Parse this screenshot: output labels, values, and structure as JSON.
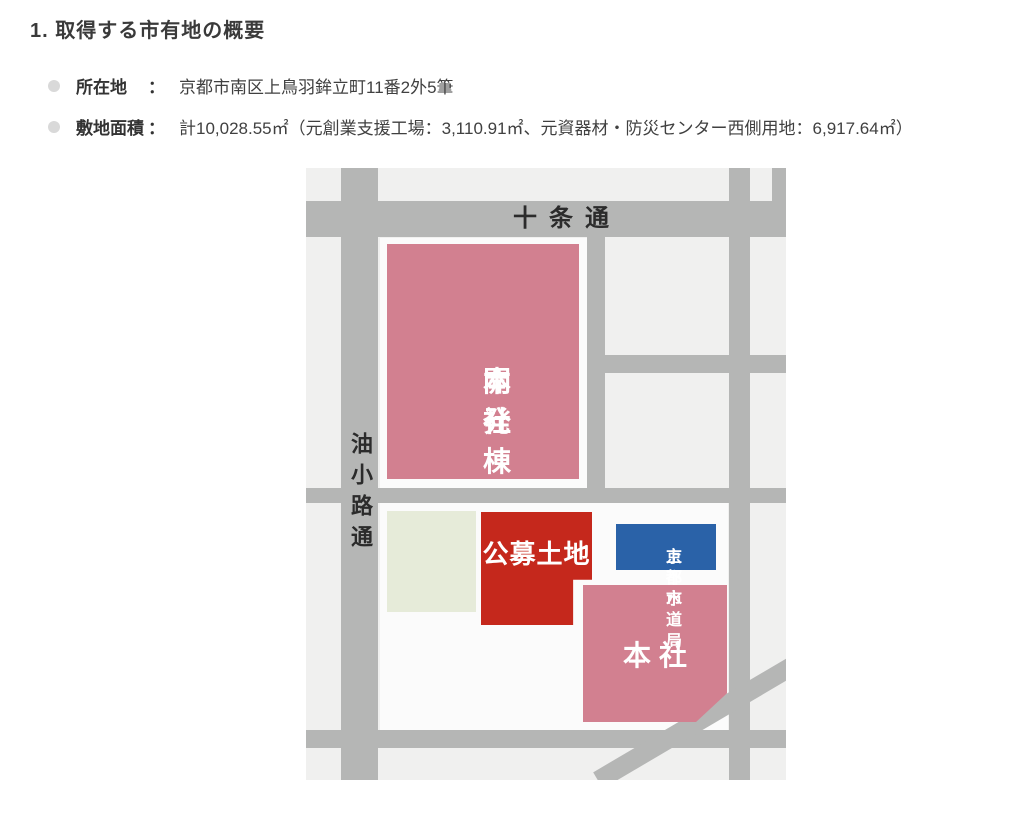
{
  "page": {
    "title": "1. 取得する市有地の概要",
    "bullets": [
      {
        "label": "所在地",
        "separator": "：",
        "value": "京都市南区上鳥羽鉾立町11番2外5筆"
      },
      {
        "label": "敷地面積",
        "separator": "：",
        "value": "計10,028.55㎡（元創業支援工場：3,110.91㎡、元資器材・防災センター西側用地：6,917.64㎡）"
      }
    ]
  },
  "map": {
    "streets": {
      "jujo": "十条通",
      "aburanokoji": "油小路通"
    },
    "buildings": {
      "head_office_dev": {
        "label_line1": "本社",
        "label_line2": "開発棟",
        "color": "#d28090"
      },
      "public_offering_land": {
        "label": "公募土地",
        "color": "#c5281c"
      },
      "waterworks_bureau": {
        "label_line1": "京都市",
        "label_line2": "上下水道局",
        "color": "#2a62a8"
      },
      "head_office": {
        "label": "本社",
        "color": "#d28090"
      },
      "vacant_lot": {
        "color": "#e6ebd9"
      }
    },
    "colors": {
      "street": "#b5b6b5",
      "map_background": "#f0f0ef",
      "block_white": "#fbfbfb"
    }
  }
}
